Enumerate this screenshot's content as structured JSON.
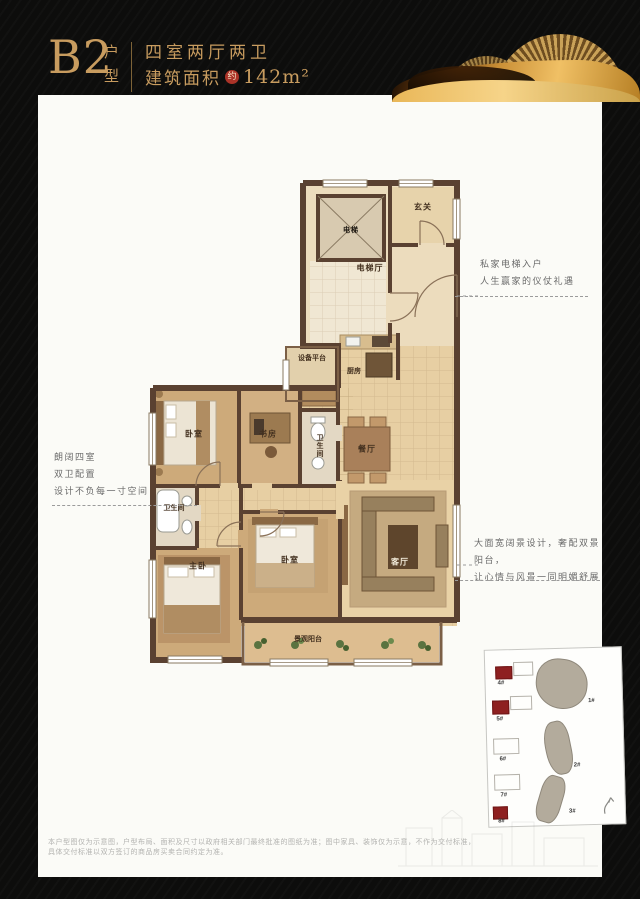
{
  "header": {
    "unit_code": "B2",
    "unit_type_char_1": "户",
    "unit_type_char_2": "型",
    "spec_line": "四室两厅两卫",
    "area_prefix": "建筑面积",
    "area_seal": "约",
    "area_value": "142m²",
    "accent_color": "#c89c5f",
    "seal_color": "#ab3328"
  },
  "floorplan": {
    "rooms": [
      {
        "label": "电梯"
      },
      {
        "label": "电梯厅"
      },
      {
        "label": "玄关"
      },
      {
        "label": "设备平台"
      },
      {
        "label": "厨房"
      },
      {
        "label": "卧室"
      },
      {
        "label": "书房"
      },
      {
        "label": "卫生间"
      },
      {
        "label": "餐厅"
      },
      {
        "label": "卫生间"
      },
      {
        "label": "主卧"
      },
      {
        "label": "卧室"
      },
      {
        "label": "客厅"
      },
      {
        "label": "景观阳台"
      }
    ],
    "annotations": {
      "left": {
        "lines": [
          "朗阔四室",
          "双卫配置",
          "设计不负每一寸空间"
        ]
      },
      "right_top": {
        "lines": [
          "私家电梯入户",
          "人生赢家的仪仗礼遇"
        ]
      },
      "right_bottom": {
        "lines": [
          "大面宽阔景设计，奢配双景阳台，",
          "让心情与风景一同明媚舒展"
        ]
      }
    },
    "colors": {
      "wall": "#5a4131",
      "floor": "#e7cfa3",
      "wood": "#cdaa7a",
      "tile": "#f0e7d3"
    }
  },
  "siteplan": {
    "gray_buildings": [
      {
        "label": "1#"
      },
      {
        "label": "2#"
      },
      {
        "label": "3#"
      }
    ],
    "red_buildings": [
      {
        "label": "4#"
      },
      {
        "label": "5#"
      },
      {
        "label": "6#"
      },
      {
        "label": "7#"
      },
      {
        "label": "8#"
      }
    ],
    "highlight_color": "#8e2020"
  },
  "footer": {
    "line1": "本户型图仅为示意图，户型布局、面积及尺寸以政府相关部门最终批准的图纸为准；图中家具、装饰仅为示意，不作为交付标准，",
    "line2": "具体交付标准以双方签订的商品房买卖合同约定为准。"
  }
}
